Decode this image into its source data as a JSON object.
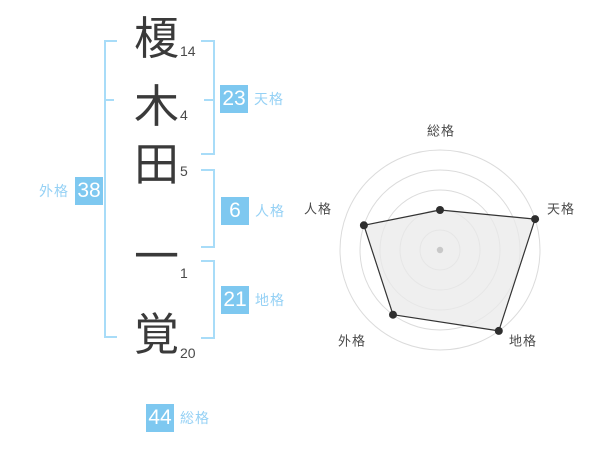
{
  "name_panel": {
    "characters": [
      {
        "char": "榎",
        "strokes": "14"
      },
      {
        "char": "木",
        "strokes": "4"
      },
      {
        "char": "田",
        "strokes": "5"
      },
      {
        "char": "一",
        "strokes": "1"
      },
      {
        "char": "覚",
        "strokes": "20"
      }
    ],
    "badges": {
      "tenkaku": {
        "value": "23",
        "label": "天格"
      },
      "jinkaku": {
        "value": "6",
        "label": "人格"
      },
      "chikaku": {
        "value": "21",
        "label": "地格"
      },
      "gaikaku": {
        "value": "38",
        "label": "外格"
      },
      "soukaku": {
        "value": "44",
        "label": "総格"
      }
    }
  },
  "chart_data": {
    "type": "radar",
    "categories": [
      "総格",
      "天格",
      "地格",
      "外格",
      "人格"
    ],
    "values": [
      40,
      100,
      100,
      80,
      80
    ],
    "scale": {
      "min": 0,
      "max": 100,
      "rings": 5
    },
    "title": "",
    "legend": "none",
    "grid": "concentric-circles",
    "orientation": "総格 at top, clockwise: 天格, 地格, 外格, 人格"
  },
  "colors": {
    "badge_blue": "#7EC8F0",
    "bracket_blue": "#A8DCF8",
    "label_blue": "#95D1F5",
    "badge_text": "#FFFFFF",
    "ink": "#3A3A3A",
    "stroke_number": "#4A4A4A",
    "background": "#FFFFFF",
    "radar_ring": "#DBDBDB",
    "radar_line": "#333333",
    "radar_fill": "#E9E9E9",
    "radar_dot": "#2E2E2E",
    "radar_center_dot": "#C8C8C8",
    "radar_label": "#4A4A4A"
  }
}
